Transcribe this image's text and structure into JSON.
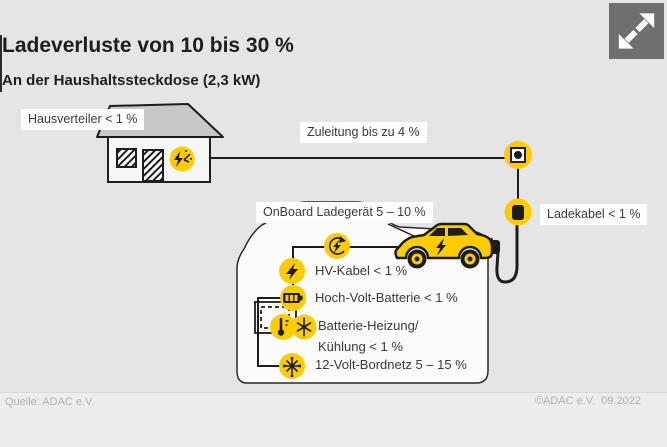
{
  "colors": {
    "background": "#e5e5e5",
    "accent_yellow": "#ffcc00",
    "outline_dark": "#1d1d1b",
    "panel_white": "#fbfbfb",
    "roof_gray": "#c8c8c8",
    "footer_text_gray": "#b1b1b1",
    "expand_button_gray": "#6f6f6f"
  },
  "header": {
    "title": "Ladeverluste von 10 bis 30 %",
    "subtitle": "An der Haushaltssteckdose (2,3 kW)"
  },
  "controls": {
    "expand_button_icon": "expand-arrows-icon"
  },
  "diagram": {
    "house": {
      "label": "Hausverteiler < 1 %",
      "icon": "electric-meter-icon"
    },
    "supply": {
      "label": "Zuleitung bis zu 4 %",
      "socket_icon": "wall-socket-icon"
    },
    "charging_cable": {
      "label": "Ladekabel < 1 %",
      "plug_icon": "charging-plug-icon"
    },
    "onboard_charger": {
      "label": "OnBoard Ladegerät 5 – 10 %",
      "icon": "onboard-charger-icon"
    },
    "components": [
      {
        "icon": "lightning-bolt-icon",
        "label": "HV-Kabel < 1 %"
      },
      {
        "icon": "battery-icon",
        "label": "Hoch-Volt-Batterie < 1 %"
      },
      {
        "icons": [
          "heating-thermometer-icon",
          "cooling-snowflake-icon"
        ],
        "label_line1": "Batterie-Heizung/",
        "label_line2": "Kühlung < 1 %"
      },
      {
        "icon": "onboard-network-icon",
        "label": "12-Volt-Bordnetz 5 – 15 %"
      }
    ]
  },
  "footer": {
    "source": "Quelle: ADAC e.V.",
    "copyright": "©ADAC e.V.  09.2022"
  }
}
